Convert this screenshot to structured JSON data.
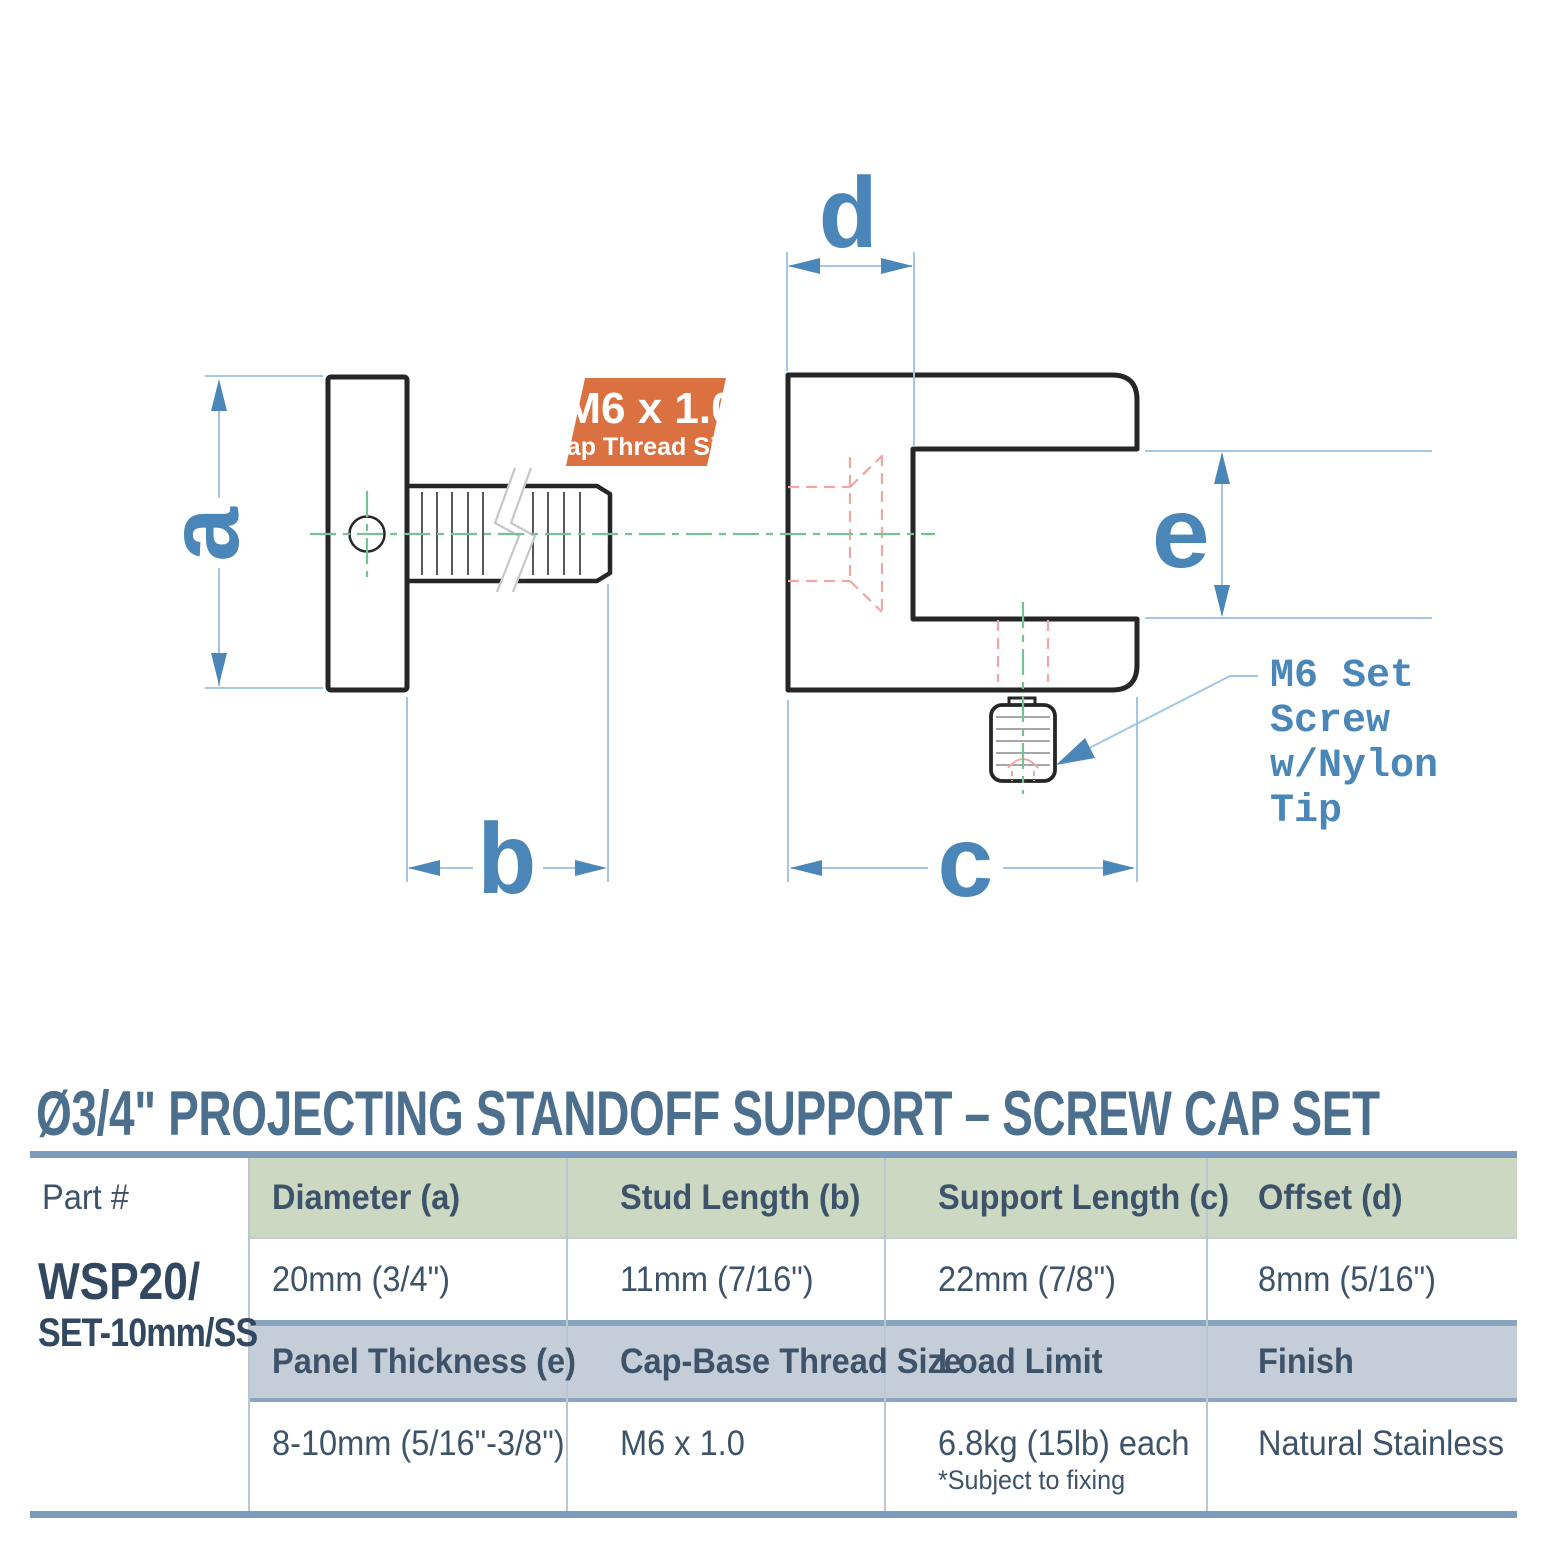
{
  "title": "Ø3/4\" PROJECTING STANDOFF SUPPORT – SCREW CAP SET",
  "drawing": {
    "dim_labels": {
      "a": "a",
      "b": "b",
      "c": "c",
      "d": "d",
      "e": "e"
    },
    "badge": {
      "line1": "M6 x 1.0",
      "line2": "Cap Thread Size",
      "color": "#db7140"
    },
    "leader_note": {
      "line1": "M6 Set",
      "line2": "Screw",
      "line3": "w/Nylon",
      "line4": "Tip"
    },
    "colors": {
      "outline": "#262626",
      "dimension_blue": "#4a86b8",
      "dim_line_blue": "#a2c6e4",
      "centerline_green": "#78c194",
      "hidden_red": "#f1a6a6"
    }
  },
  "table": {
    "accent": {
      "header_green": "#ccd8c2",
      "header_gray": "#c5ced8",
      "rule_blue": "#7d9bbd"
    },
    "part_label": "Part #",
    "part_number_line1": "WSP20/",
    "part_number_line2": "SET-10mm/SS",
    "header_row1": [
      "Diameter (a)",
      "Stud Length (b)",
      "Support Length (c)",
      "Offset (d)"
    ],
    "value_row1": [
      "20mm (3/4\")",
      "11mm (7/16\")",
      "22mm (7/8\")",
      "8mm (5/16\")"
    ],
    "header_row2": [
      "Panel Thickness (e)",
      "Cap-Base Thread Size",
      "Load Limit",
      "Finish"
    ],
    "value_row2": [
      "8-10mm (5/16\"-3/8\")",
      "M6 x 1.0",
      "6.8kg (15lb) each",
      "Natural Stainless"
    ],
    "footnote": "*Subject to fixing"
  }
}
